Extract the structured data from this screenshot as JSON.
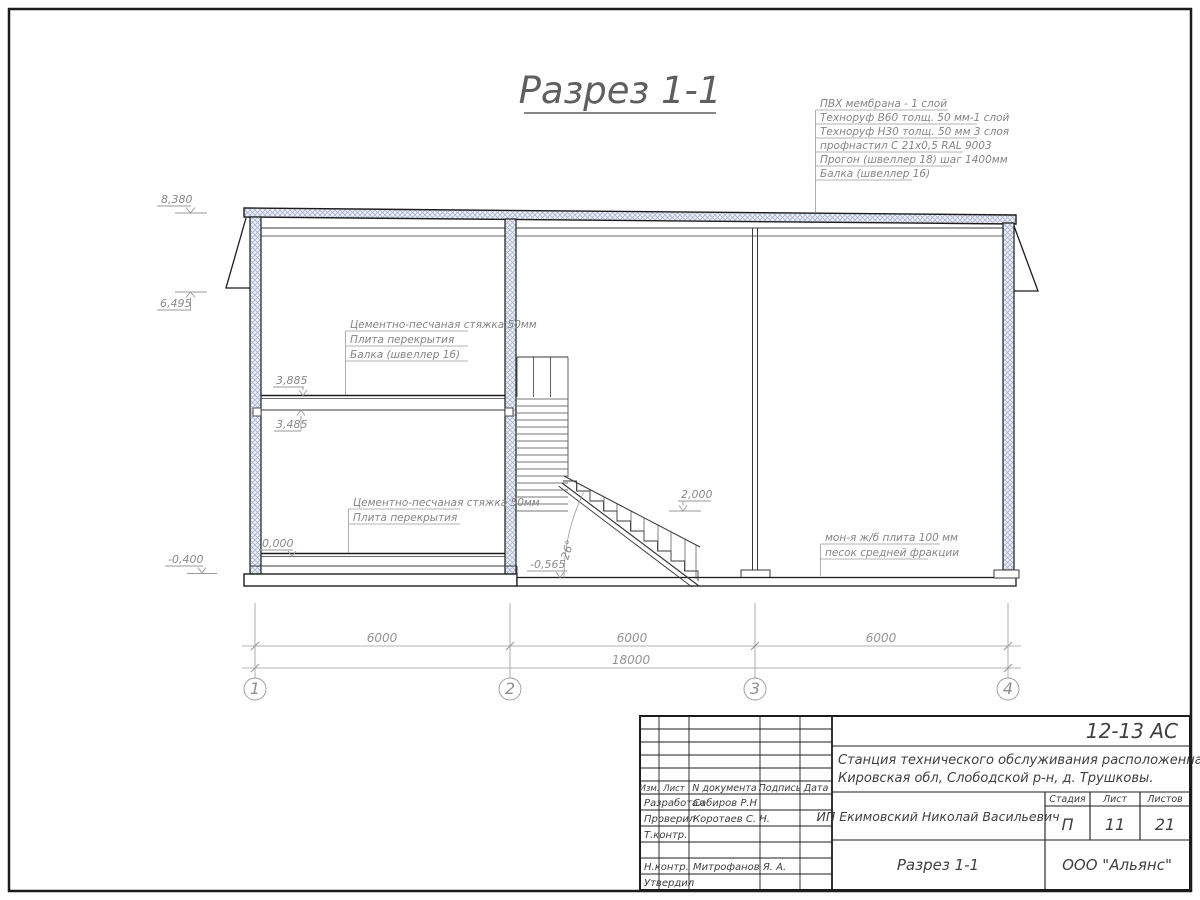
{
  "sheet": {
    "title": "Разрез 1-1"
  },
  "roof_note": {
    "lines": [
      "ПВХ мембрана - 1 слой",
      "Техноруф В60 толщ. 50 мм-1 слой",
      "Техноруф Н30 толщ. 50 мм 3 слоя",
      "профнастил С 21х0,5 RAL 9003",
      "Прогон (швеллер 18) шаг 1400мм",
      "Балка (швеллер 16)"
    ]
  },
  "floor2_note": {
    "lines": [
      "Цементно-песчаная стяжка 50мм",
      "Плита перекрытия",
      "Балка (швеллер 16)"
    ]
  },
  "floor1_note": {
    "lines": [
      "Цементно-песчаная стяжка 50мм",
      "Плита перекрытия"
    ]
  },
  "ground_note": {
    "lines": [
      "мон-я ж/б плита 100 мм",
      "песок средней фракции"
    ]
  },
  "elevations": {
    "roof": "8,380",
    "eave": "6,495",
    "floor2_top": "3,885",
    "floor2_bottom": "3,485",
    "zero": "0,000",
    "base": "-0,400",
    "landing": "2,000",
    "pit": "-0,565"
  },
  "stairs": {
    "angle": "26°"
  },
  "dimensions": {
    "span1": "6000",
    "span2": "6000",
    "span3": "6000",
    "total": "18000"
  },
  "axes": {
    "a1": "1",
    "a2": "2",
    "a3": "3",
    "a4": "4"
  },
  "titleblock": {
    "doc_code": "12-13 АС",
    "project_line1": "Станция технического обслуживания расположенная по адресу",
    "project_line2": "Кировская обл, Слободской р-н, д. Трушковы.",
    "client": "ИП Екимовский Николай Васильевич",
    "stage_label": "Стадия",
    "sheet_label": "Лист",
    "sheets_label": "Листов",
    "stage": "П",
    "sheet_no": "11",
    "sheets_total": "21",
    "drawing_name": "Разрез 1-1",
    "company": "ООО \"Альянс\"",
    "col_izm": "Изм.",
    "col_list": "Лист",
    "col_doc": "N документа",
    "col_sign": "Подпись",
    "col_date": "Дата",
    "rows": [
      {
        "role": "Разработал",
        "name": "Сабиров Р.Н"
      },
      {
        "role": "Проверил",
        "name": "Коротаев С. Н."
      },
      {
        "role": "Т.контр.",
        "name": ""
      },
      {
        "role": "Н.контр.",
        "name": "Митрофанов Я. А."
      },
      {
        "role": "Утвердил",
        "name": ""
      }
    ]
  }
}
